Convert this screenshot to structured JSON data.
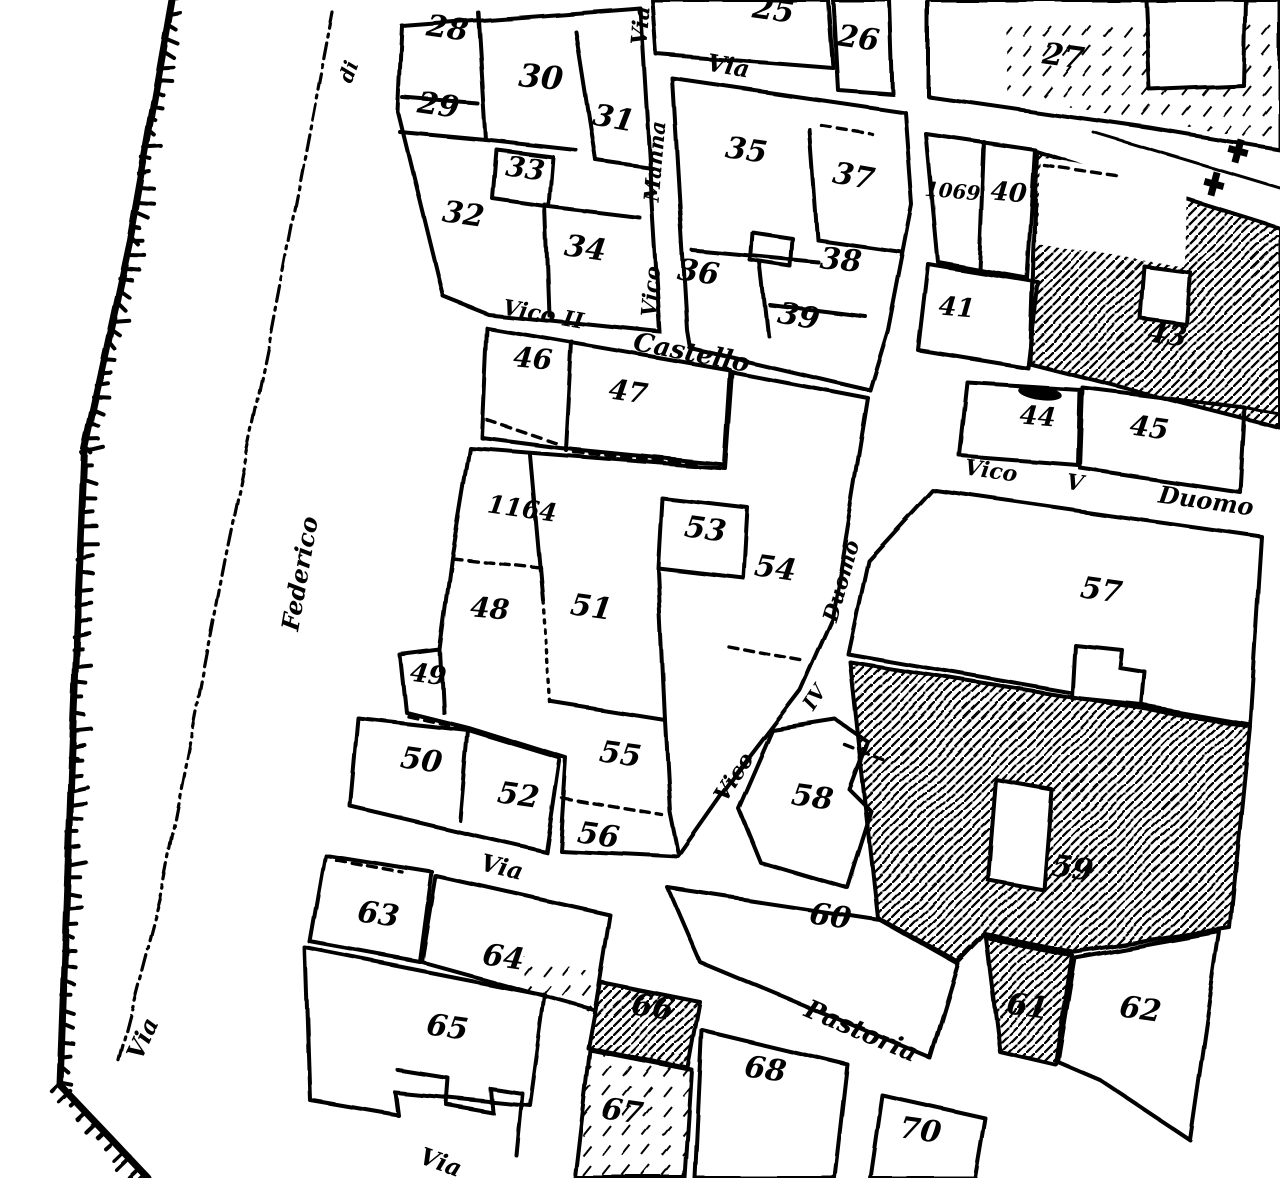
{
  "canvas": {
    "width": 1280,
    "height": 1178
  },
  "colors": {
    "ink": "#000000",
    "paper": "#ffffff"
  },
  "map": {
    "kind": "cadastral town plan (scanned, black ink on white)",
    "parcel_labels": [
      {
        "text": "28",
        "x": 446,
        "y": 38,
        "rot": 8,
        "size": 30
      },
      {
        "text": "29",
        "x": 437,
        "y": 115,
        "rot": 8,
        "size": 30
      },
      {
        "text": "30",
        "x": 540,
        "y": 88,
        "rot": 5,
        "size": 32
      },
      {
        "text": "31",
        "x": 612,
        "y": 128,
        "rot": 10,
        "size": 30
      },
      {
        "text": "32",
        "x": 462,
        "y": 224,
        "rot": 8,
        "size": 30
      },
      {
        "text": "33",
        "x": 524,
        "y": 178,
        "rot": 8,
        "size": 28
      },
      {
        "text": "34",
        "x": 584,
        "y": 258,
        "rot": 8,
        "size": 30
      },
      {
        "text": "25",
        "x": 772,
        "y": 20,
        "rot": 8,
        "size": 30
      },
      {
        "text": "26",
        "x": 857,
        "y": 48,
        "rot": 8,
        "size": 30
      },
      {
        "text": "27",
        "x": 1062,
        "y": 66,
        "rot": 8,
        "size": 30
      },
      {
        "text": "35",
        "x": 745,
        "y": 160,
        "rot": 8,
        "size": 30
      },
      {
        "text": "36",
        "x": 697,
        "y": 282,
        "rot": 8,
        "size": 30
      },
      {
        "text": "37",
        "x": 852,
        "y": 186,
        "rot": 10,
        "size": 30
      },
      {
        "text": "38",
        "x": 840,
        "y": 270,
        "rot": 5,
        "size": 30
      },
      {
        "text": "39",
        "x": 797,
        "y": 326,
        "rot": 10,
        "size": 30
      },
      {
        "text": "1069",
        "x": 952,
        "y": 198,
        "rot": 5,
        "size": 20
      },
      {
        "text": "40",
        "x": 1008,
        "y": 201,
        "rot": 5,
        "size": 26
      },
      {
        "text": "41",
        "x": 956,
        "y": 316,
        "rot": 5,
        "size": 26
      },
      {
        "text": "43",
        "x": 1166,
        "y": 344,
        "rot": 8,
        "size": 28
      },
      {
        "text": "44",
        "x": 1037,
        "y": 425,
        "rot": 5,
        "size": 26
      },
      {
        "text": "45",
        "x": 1148,
        "y": 437,
        "rot": 8,
        "size": 28
      },
      {
        "text": "46",
        "x": 532,
        "y": 368,
        "rot": 5,
        "size": 28
      },
      {
        "text": "47",
        "x": 627,
        "y": 401,
        "rot": 8,
        "size": 28
      },
      {
        "text": "1164",
        "x": 521,
        "y": 517,
        "rot": 8,
        "size": 25
      },
      {
        "text": "48",
        "x": 489,
        "y": 618,
        "rot": 5,
        "size": 28
      },
      {
        "text": "49",
        "x": 427,
        "y": 683,
        "rot": 8,
        "size": 26
      },
      {
        "text": "50",
        "x": 420,
        "y": 770,
        "rot": 8,
        "size": 30
      },
      {
        "text": "51",
        "x": 590,
        "y": 617,
        "rot": 8,
        "size": 30
      },
      {
        "text": "52",
        "x": 517,
        "y": 805,
        "rot": 8,
        "size": 30
      },
      {
        "text": "53",
        "x": 704,
        "y": 539,
        "rot": 8,
        "size": 30
      },
      {
        "text": "54",
        "x": 774,
        "y": 578,
        "rot": 8,
        "size": 30
      },
      {
        "text": "55",
        "x": 619,
        "y": 764,
        "rot": 8,
        "size": 30
      },
      {
        "text": "56",
        "x": 597,
        "y": 845,
        "rot": 8,
        "size": 30
      },
      {
        "text": "57",
        "x": 1100,
        "y": 600,
        "rot": 8,
        "size": 30
      },
      {
        "text": "58",
        "x": 811,
        "y": 807,
        "rot": 8,
        "size": 30
      },
      {
        "text": "59",
        "x": 1071,
        "y": 878,
        "rot": 8,
        "size": 30
      },
      {
        "text": "60",
        "x": 829,
        "y": 926,
        "rot": 8,
        "size": 30
      },
      {
        "text": "61",
        "x": 1026,
        "y": 1016,
        "rot": 8,
        "size": 30
      },
      {
        "text": "62",
        "x": 1139,
        "y": 1019,
        "rot": 8,
        "size": 30
      },
      {
        "text": "63",
        "x": 377,
        "y": 924,
        "rot": 8,
        "size": 30
      },
      {
        "text": "64",
        "x": 502,
        "y": 967,
        "rot": 8,
        "size": 30
      },
      {
        "text": "65",
        "x": 446,
        "y": 1037,
        "rot": 8,
        "size": 30
      },
      {
        "text": "66",
        "x": 651,
        "y": 1017,
        "rot": 8,
        "size": 30
      },
      {
        "text": "67",
        "x": 621,
        "y": 1121,
        "rot": 8,
        "size": 30
      },
      {
        "text": "68",
        "x": 764,
        "y": 1079,
        "rot": 8,
        "size": 30
      },
      {
        "text": "70",
        "x": 919,
        "y": 1140,
        "rot": 8,
        "size": 30
      }
    ],
    "street_labels": [
      {
        "text": "di",
        "x": 355,
        "y": 74,
        "rot": -70,
        "size": 20
      },
      {
        "text": "Federico",
        "x": 308,
        "y": 575,
        "rot": -80,
        "size": 24
      },
      {
        "text": "Via",
        "x": 150,
        "y": 1042,
        "rot": -65,
        "size": 24
      },
      {
        "text": "Via",
        "x": 648,
        "y": 26,
        "rot": -85,
        "size": 22
      },
      {
        "text": "Via",
        "x": 727,
        "y": 74,
        "rot": 10,
        "size": 24
      },
      {
        "text": "Manna",
        "x": 662,
        "y": 162,
        "rot": -85,
        "size": 21
      },
      {
        "text": "Vico",
        "x": 658,
        "y": 292,
        "rot": -85,
        "size": 21
      },
      {
        "text": "Vico",
        "x": 528,
        "y": 319,
        "rot": 10,
        "size": 22
      },
      {
        "text": "II",
        "x": 572,
        "y": 327,
        "rot": 10,
        "size": 22
      },
      {
        "text": "Castello",
        "x": 690,
        "y": 361,
        "rot": 11,
        "size": 26
      },
      {
        "text": "Vico",
        "x": 990,
        "y": 478,
        "rot": 8,
        "size": 22
      },
      {
        "text": "V",
        "x": 1074,
        "y": 490,
        "rot": 8,
        "size": 22
      },
      {
        "text": "Duomo",
        "x": 1205,
        "y": 509,
        "rot": 8,
        "size": 24
      },
      {
        "text": "Duomo",
        "x": 848,
        "y": 583,
        "rot": -74,
        "size": 21
      },
      {
        "text": "IV",
        "x": 820,
        "y": 701,
        "rot": -57,
        "size": 20
      },
      {
        "text": "Vico",
        "x": 740,
        "y": 781,
        "rot": -57,
        "size": 22
      },
      {
        "text": "Via",
        "x": 500,
        "y": 875,
        "rot": 14,
        "size": 24
      },
      {
        "text": "Pastoria",
        "x": 858,
        "y": 1039,
        "rot": 23,
        "size": 26
      },
      {
        "text": "Via",
        "x": 438,
        "y": 1170,
        "rot": 20,
        "size": 24
      }
    ],
    "symbols": [
      {
        "name": "church-cross-marker",
        "x": 1238,
        "y": 151,
        "rot": 15
      },
      {
        "name": "church-cross-marker",
        "x": 1214,
        "y": 184,
        "rot": 15
      },
      {
        "name": "ink-blob",
        "x": 1040,
        "y": 393,
        "rot": 8
      }
    ]
  }
}
